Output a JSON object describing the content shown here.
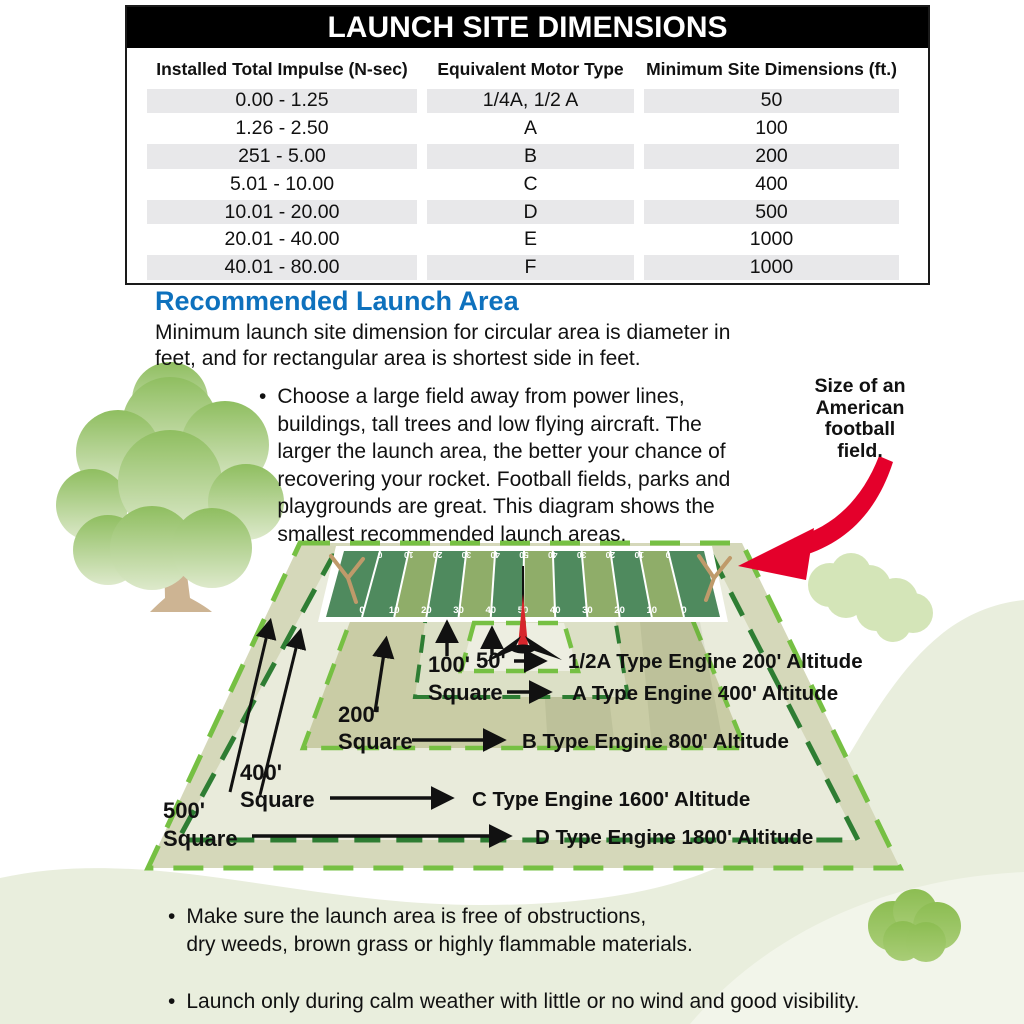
{
  "table": {
    "title": "LAUNCH SITE DIMENSIONS",
    "columns": [
      "Installed Total Impulse (N-sec)",
      "Equivalent Motor Type",
      "Minimum Site Dimensions (ft.)"
    ],
    "rows": [
      [
        "0.00 - 1.25",
        "1/4A, 1/2 A",
        "50"
      ],
      [
        "1.26 - 2.50",
        "A",
        "100"
      ],
      [
        "251 - 5.00",
        "B",
        "200"
      ],
      [
        "5.01 - 10.00",
        "C",
        "400"
      ],
      [
        "10.01 - 20.00",
        "D",
        "500"
      ],
      [
        "20.01 - 40.00",
        "E",
        "1000"
      ],
      [
        "40.01 - 80.00",
        "F",
        "1000"
      ]
    ]
  },
  "section": {
    "heading": "Recommended Launch Area",
    "intro": "Minimum launch site dimension for circular area is diameter in\nfeet, and for rectangular area is shortest side in feet.",
    "bullet_marker": "•",
    "bullet_choose": "Choose a large field away from power lines,\nbuildings, tall trees and low flying aircraft. The\nlarger the launch area, the better your chance of\nrecovering your rocket. Football fields, parks and\nplaygrounds are great. This diagram shows the\nsmallest recommended launch areas.",
    "football_note": "Size of an\nAmerican\nfootball\nfield."
  },
  "diagram": {
    "squares": [
      {
        "size_label": "50'",
        "engine_label": "1/2A Type Engine 200' Altitude"
      },
      {
        "size_label": "100'",
        "square_word": "Square",
        "engine_label": "A Type Engine 400' Altitude"
      },
      {
        "size_label": "200'",
        "square_word": "Square",
        "engine_label": "B Type Engine 800' Altitude"
      },
      {
        "size_label": "400'",
        "square_word": "Square",
        "engine_label": "C Type Engine 1600' Altitude"
      },
      {
        "size_label": "500'",
        "square_word": "Square",
        "engine_label": "D Type Engine 1800' Altitude"
      }
    ],
    "field": {
      "yard_numbers": [
        "0",
        "10",
        "20",
        "30",
        "40",
        "50",
        "40",
        "30",
        "20",
        "10",
        "0"
      ]
    },
    "icons": [
      "rocket-icon",
      "goalpost-icon",
      "tree-illustration",
      "bush-illustration",
      "red-arrow-icon"
    ]
  },
  "bottom_bullets": [
    "Make sure the launch area is free of obstructions,\ndry weeds, brown grass or highly flammable materials.",
    "Launch only during calm weather with little or no wind and good visibility."
  ],
  "colors": {
    "accent_blue": "#0e71bd",
    "dash_bright": "#76c043",
    "dash_dark": "#2e7d33",
    "field_dark": "#4f8a5e",
    "field_light": "#8fad69",
    "red_arrow": "#e4002b",
    "table_stripe": "#e8e8ea"
  }
}
